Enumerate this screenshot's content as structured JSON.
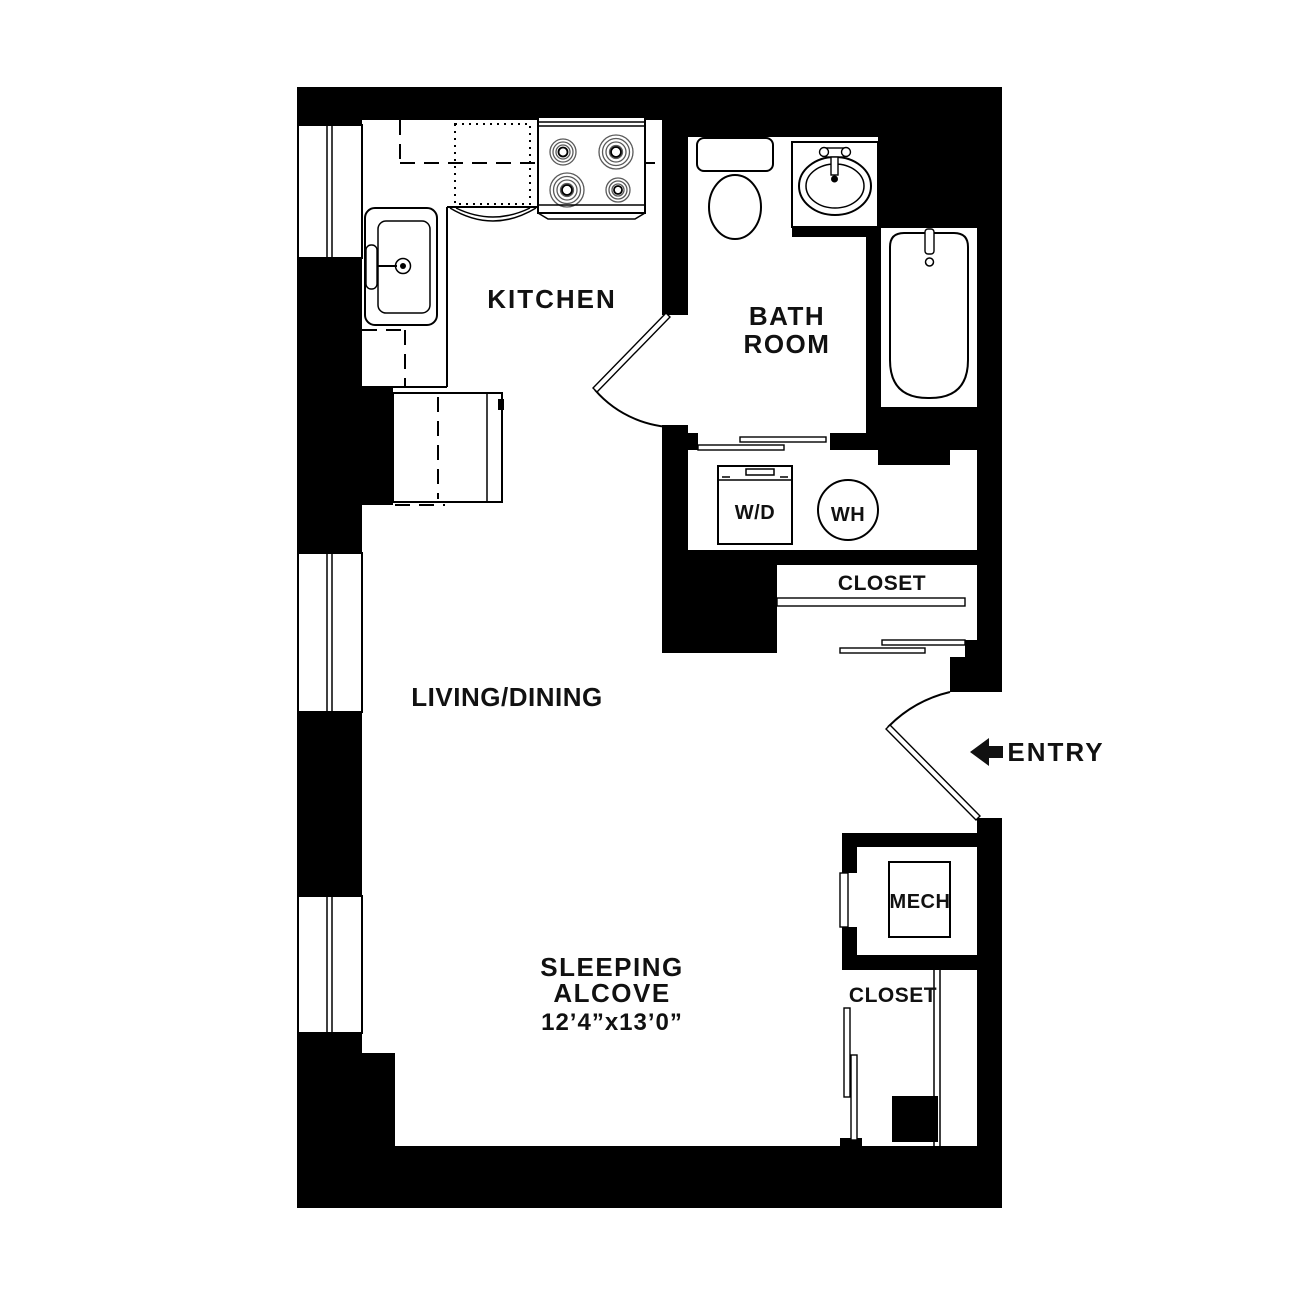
{
  "floor_plan": {
    "rooms": {
      "kitchen": {
        "label": "KITCHEN"
      },
      "bathroom": {
        "label_line1": "BATH",
        "label_line2": "ROOM"
      },
      "living_dining": {
        "label": "LIVING/DINING"
      },
      "sleeping_alcove": {
        "label_line1": "SLEEPING",
        "label_line2": "ALCOVE",
        "dimensions": "12’4”x13’0”"
      },
      "closet_upper": {
        "label": "CLOSET"
      },
      "closet_lower": {
        "label": "CLOSET"
      },
      "mech": {
        "label": "MECH"
      },
      "entry": {
        "label": "ENTRY"
      }
    },
    "fixtures": {
      "washer_dryer": {
        "label": "W/D"
      },
      "water_heater": {
        "label": "WH"
      }
    },
    "colors": {
      "wall": "#000000",
      "background": "#ffffff",
      "line": "#000000"
    }
  }
}
